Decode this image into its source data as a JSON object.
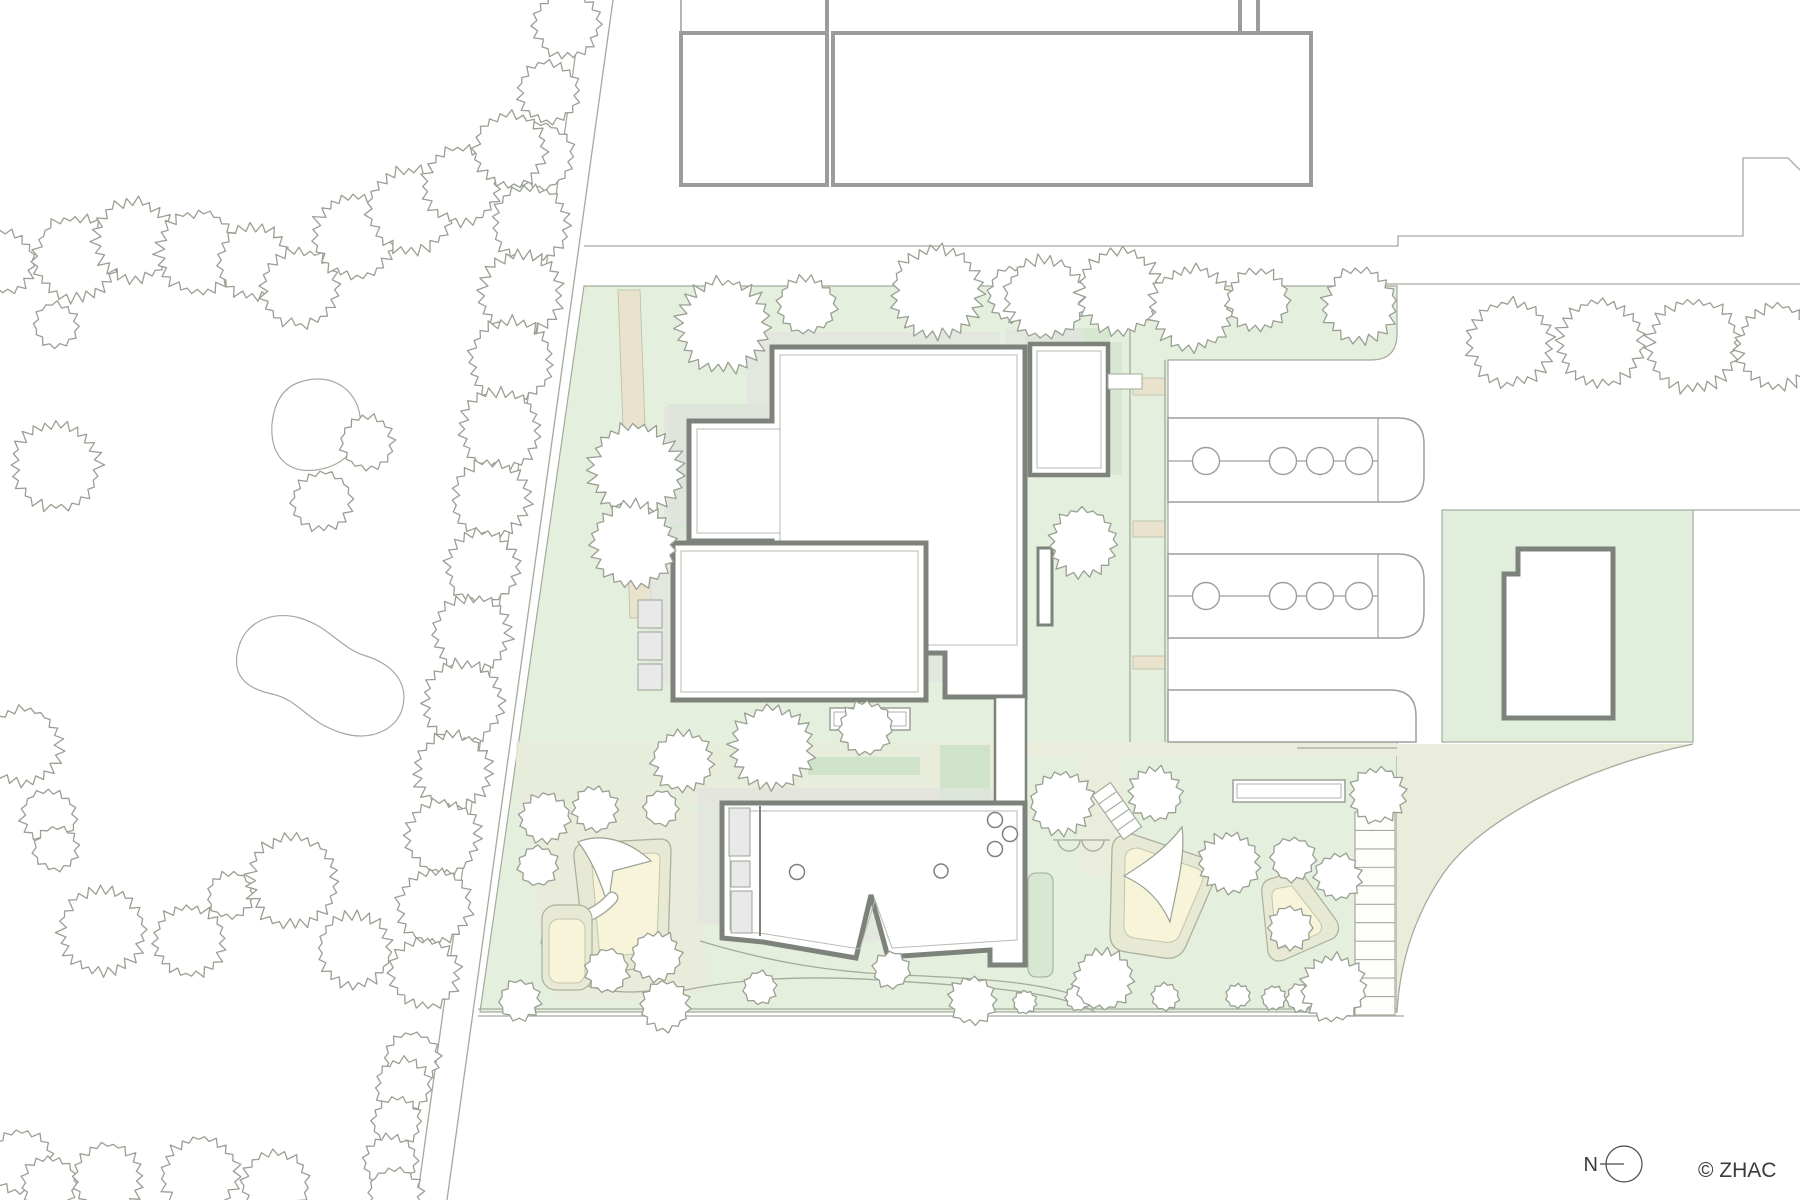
{
  "annotations": {
    "north_label": "N",
    "copyright": "© ZHAC"
  },
  "palette": {
    "site_green": "#e4efdd",
    "sage": "#d8e7d2",
    "dark_sage": "#cfe3c9",
    "olive": "#eaecdc",
    "sand": "#f8f4da",
    "beige": "#e9e3cd",
    "shadow": "#e2e4e0",
    "wall": "#7d837b",
    "neighbor_wall": "#9c9c9c",
    "thin_line": "#a4aa9d",
    "tree_stroke": "#99a093",
    "window": "#e9e9e9",
    "text": "#3a3a3a"
  },
  "trees": [
    [
      567,
      25,
      36
    ],
    [
      548,
      92,
      33
    ],
    [
      540,
      156,
      36
    ],
    [
      531,
      224,
      42
    ],
    [
      521,
      293,
      44
    ],
    [
      511,
      361,
      46
    ],
    [
      500,
      430,
      44
    ],
    [
      491,
      499,
      42
    ],
    [
      482,
      567,
      40
    ],
    [
      472,
      634,
      42
    ],
    [
      463,
      702,
      44
    ],
    [
      453,
      771,
      42
    ],
    [
      443,
      837,
      40
    ],
    [
      434,
      906,
      40
    ],
    [
      425,
      973,
      38
    ],
    [
      412,
      1060,
      30
    ],
    [
      403,
      1086,
      30
    ],
    [
      397,
      1121,
      27
    ],
    [
      390,
      1162,
      29
    ],
    [
      395,
      1195,
      30
    ],
    [
      4,
      262,
      34
    ],
    [
      76,
      258,
      46
    ],
    [
      134,
      240,
      44
    ],
    [
      198,
      252,
      45
    ],
    [
      254,
      262,
      40
    ],
    [
      300,
      288,
      42
    ],
    [
      355,
      236,
      46
    ],
    [
      410,
      210,
      46
    ],
    [
      462,
      185,
      42
    ],
    [
      510,
      150,
      40
    ],
    [
      56,
      325,
      24
    ],
    [
      56,
      465,
      48
    ],
    [
      367,
      442,
      29
    ],
    [
      322,
      501,
      32
    ],
    [
      23,
      746,
      42
    ],
    [
      49,
      817,
      30
    ],
    [
      56,
      849,
      24
    ],
    [
      102,
      931,
      47
    ],
    [
      189,
      941,
      39
    ],
    [
      230,
      895,
      25
    ],
    [
      293,
      881,
      50
    ],
    [
      355,
      950,
      40
    ],
    [
      21,
      1162,
      34
    ],
    [
      49,
      1184,
      30
    ],
    [
      108,
      1179,
      38
    ],
    [
      200,
      1175,
      42
    ],
    [
      275,
      1184,
      36
    ],
    [
      636,
      470,
      50
    ],
    [
      633,
      545,
      46
    ],
    [
      723,
      325,
      50
    ],
    [
      807,
      305,
      31
    ],
    [
      937,
      292,
      49
    ],
    [
      1016,
      295,
      31
    ],
    [
      1045,
      298,
      44
    ],
    [
      1120,
      292,
      46
    ],
    [
      1192,
      308,
      46
    ],
    [
      1258,
      300,
      34
    ],
    [
      1360,
      305,
      40
    ],
    [
      1510,
      343,
      46
    ],
    [
      1600,
      343,
      47
    ],
    [
      1693,
      345,
      50
    ],
    [
      1778,
      346,
      45
    ],
    [
      1083,
      543,
      37
    ],
    [
      772,
      748,
      45
    ],
    [
      866,
      728,
      29
    ],
    [
      683,
      761,
      33
    ],
    [
      538,
      866,
      22
    ],
    [
      545,
      818,
      27
    ],
    [
      595,
      809,
      25
    ],
    [
      661,
      808,
      19
    ],
    [
      607,
      971,
      24
    ],
    [
      656,
      956,
      27
    ],
    [
      520,
      1000,
      22
    ],
    [
      665,
      1006,
      27
    ],
    [
      760,
      988,
      18
    ],
    [
      891,
      970,
      20
    ],
    [
      972,
      1000,
      26
    ],
    [
      1025,
      1002,
      13
    ],
    [
      1078,
      998,
      14
    ],
    [
      1062,
      803,
      34
    ],
    [
      1155,
      794,
      29
    ],
    [
      1230,
      863,
      33
    ],
    [
      1293,
      859,
      24
    ],
    [
      1338,
      877,
      25
    ],
    [
      1378,
      795,
      30
    ],
    [
      1290,
      928,
      24
    ],
    [
      1103,
      980,
      33
    ],
    [
      1165,
      997,
      15
    ],
    [
      1238,
      996,
      13
    ],
    [
      1274,
      998,
      13
    ],
    [
      1300,
      998,
      15
    ],
    [
      1334,
      988,
      36
    ]
  ],
  "parking": {
    "rows": [
      {
        "x": 1168,
        "y": 418,
        "w": 230,
        "h": 84,
        "r": 26,
        "centerline": true,
        "cy": 461
      },
      {
        "x": 1168,
        "y": 554,
        "w": 230,
        "h": 84,
        "r": 26,
        "centerline": true,
        "cy": 596
      },
      {
        "x": 1168,
        "y": 690,
        "w": 222,
        "h": 52,
        "r": 26,
        "centerline": false,
        "cy": 0
      }
    ],
    "tree_circle_x": [
      1206,
      1283,
      1320,
      1359
    ],
    "tree_circle_r": 13.5,
    "inner_line_x": 1378
  },
  "ladder": {
    "x": 1355,
    "y": 812,
    "w": 40,
    "h": 203,
    "rungs": 10
  },
  "stairs": {
    "cx": 1117,
    "cy": 811,
    "angle": -35,
    "w": 22,
    "h": 54,
    "treads": 4
  },
  "pavilion_circles": [
    [
      797,
      872,
      7.5
    ],
    [
      941,
      871,
      7
    ],
    [
      995,
      820,
      7.5
    ],
    [
      1010,
      834,
      7.5
    ],
    [
      995,
      849,
      7.5
    ]
  ]
}
